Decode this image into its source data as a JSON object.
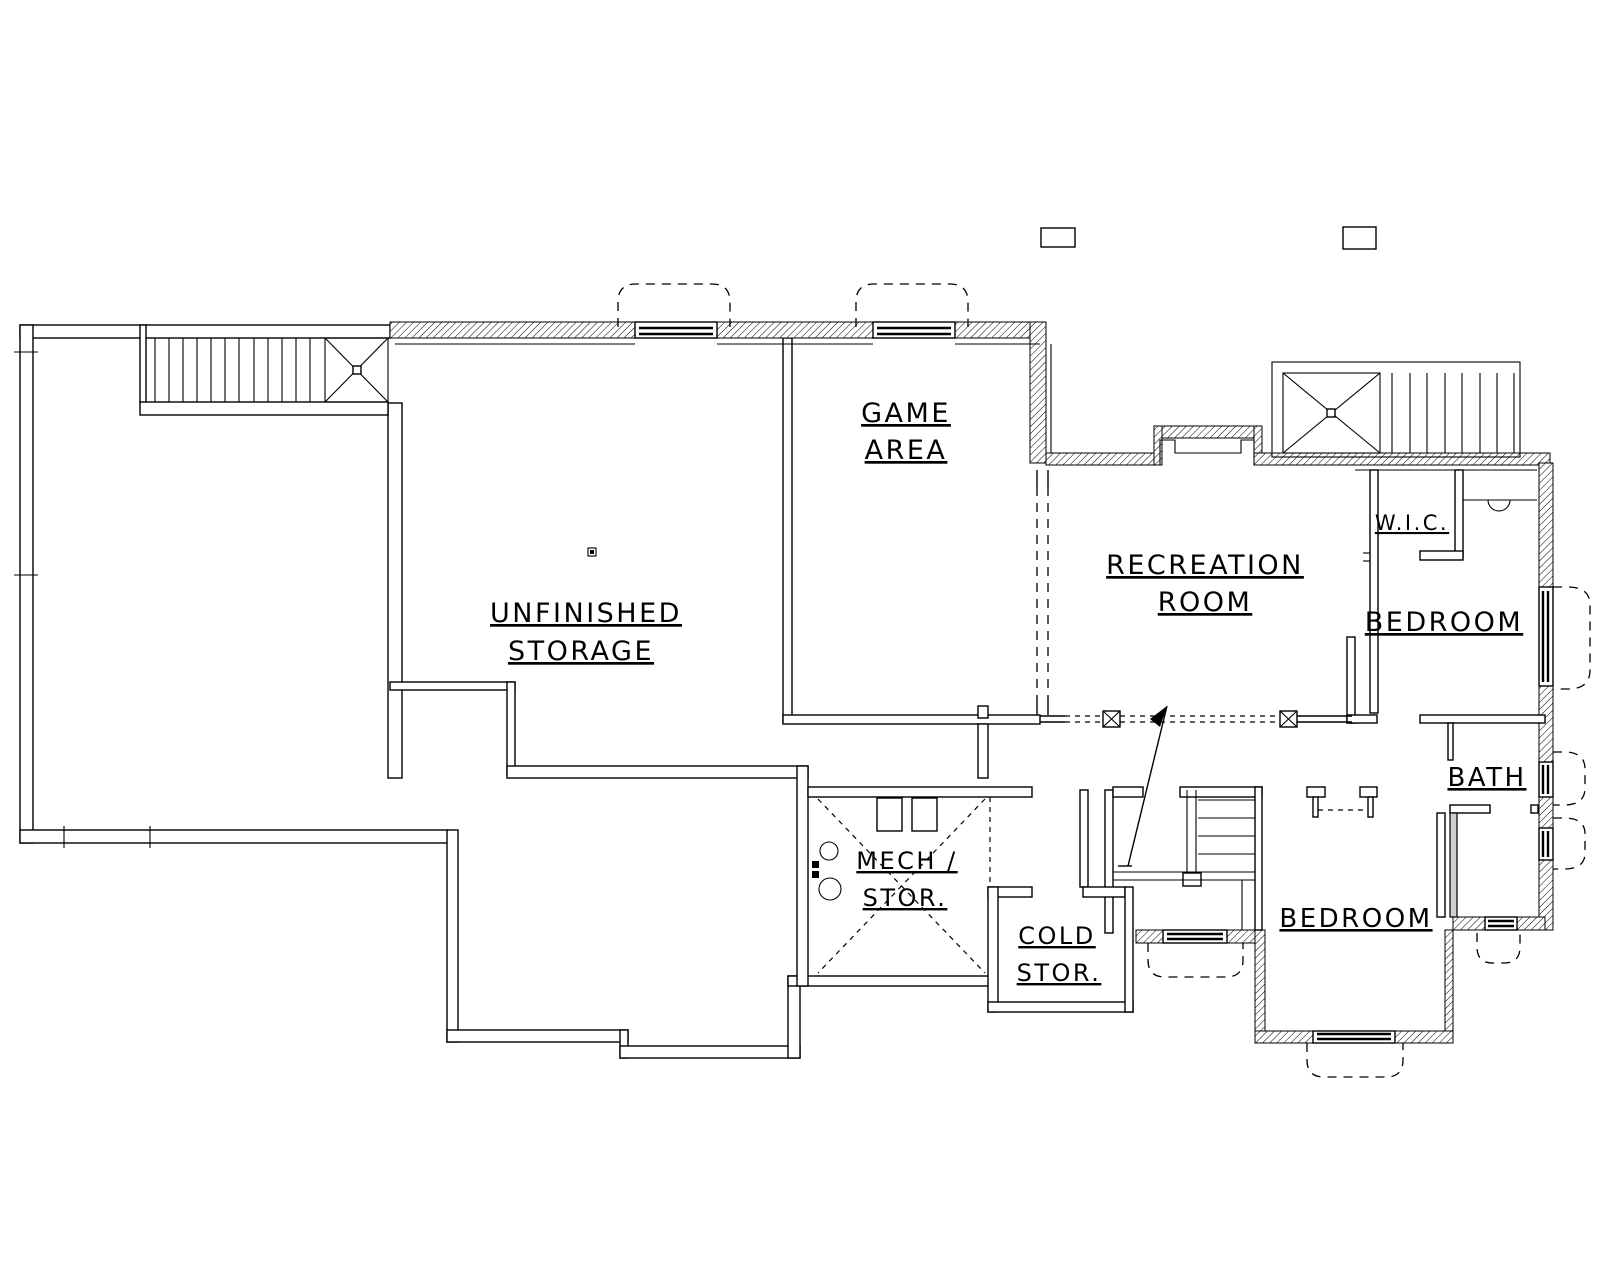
{
  "rooms": {
    "unfinished_storage": {
      "line1": "UNFINISHED",
      "line2": "STORAGE"
    },
    "game_area": {
      "line1": "GAME",
      "line2": "AREA"
    },
    "recreation_room": {
      "line1": "RECREATION",
      "line2": "ROOM"
    },
    "walk_in_closet": {
      "label": "W.I.C."
    },
    "bedroom_upper": {
      "label": "BEDROOM"
    },
    "bathroom": {
      "label": "BATH"
    },
    "bedroom_lower": {
      "label": "BEDROOM"
    },
    "mechanical_storage": {
      "line1": "MECH /",
      "line2": "STOR."
    },
    "cold_storage": {
      "line1": "COLD",
      "line2": "STOR."
    }
  },
  "colors": {
    "ink": "#000000",
    "paper": "#ffffff",
    "furred_wall_fill": "#cfcfcf"
  }
}
